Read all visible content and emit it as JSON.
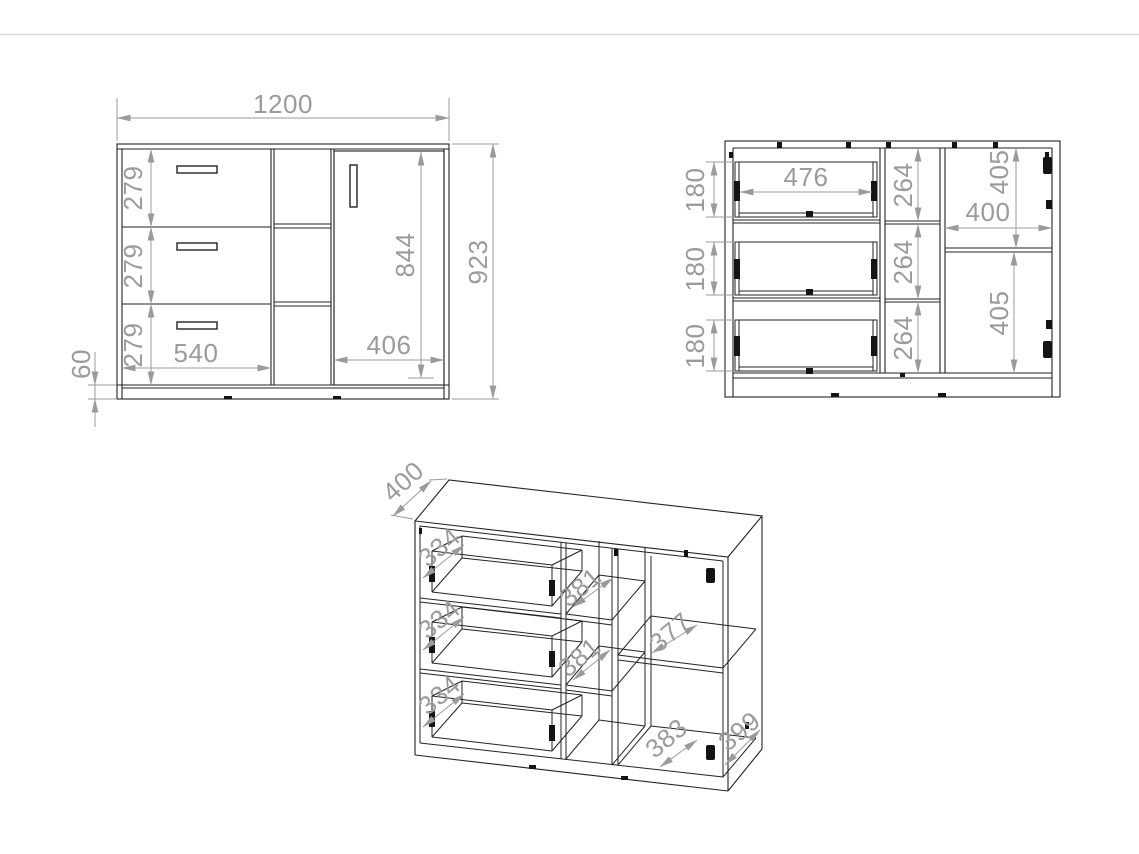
{
  "colors": {
    "background": "#ffffff",
    "line": "#232323",
    "dimension": "#9b9b9b",
    "separator": "#d9d9d9",
    "hardware": "#141414"
  },
  "drawing": {
    "front_view": {
      "dims": {
        "total_width": "1200",
        "total_height": "923",
        "door_height": "844",
        "drawer_1_height": "279",
        "drawer_2_height": "279",
        "drawer_3_height": "279",
        "drawer_front_width": "540",
        "door_front_width": "406",
        "plinth_height": "60"
      }
    },
    "interior_view": {
      "dims": {
        "drawer_box_1_height": "180",
        "drawer_box_2_height": "180",
        "drawer_box_3_height": "180",
        "drawer_box_inner_width": "476",
        "niche_1_height": "264",
        "niche_2_height": "264",
        "niche_3_height": "264",
        "door_niche_top_height": "405",
        "door_niche_bottom_height": "405",
        "door_niche_width": "400"
      }
    },
    "iso_view": {
      "dims": {
        "top_depth": "400",
        "drawer_1_depth": "334",
        "drawer_2_depth": "334",
        "drawer_3_depth": "334",
        "niche_1_depth": "381",
        "niche_2_depth": "381",
        "shelf_depth": "377",
        "bottom_depth": "383",
        "side_depth": "399"
      }
    }
  }
}
